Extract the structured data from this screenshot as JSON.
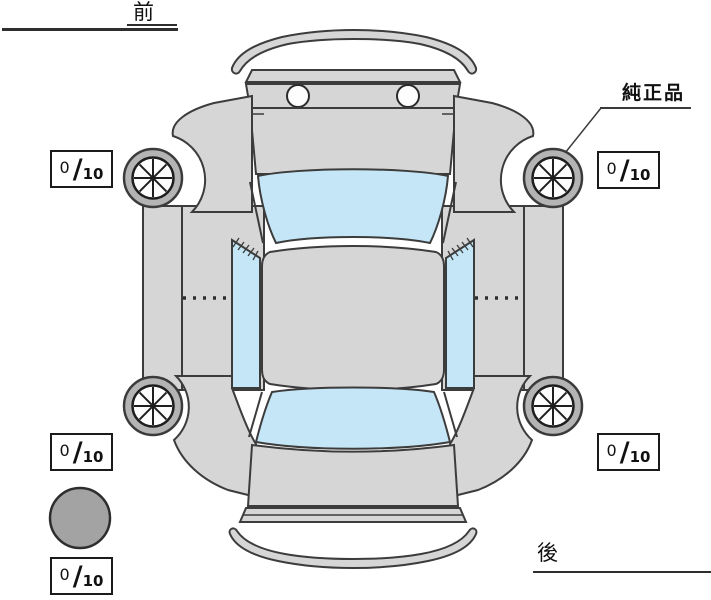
{
  "labels": {
    "front": "前",
    "rear": "後",
    "genuine_parts": "純正品"
  },
  "slash_char": "/",
  "tires": {
    "front_left": {
      "value": "0",
      "max": "10"
    },
    "front_right": {
      "value": "0",
      "max": "10"
    },
    "rear_left": {
      "value": "0",
      "max": "10"
    },
    "rear_right": {
      "value": "0",
      "max": "10"
    },
    "spare": {
      "value": "0",
      "max": "10"
    }
  },
  "colors": {
    "body_gray": "#d6d6d6",
    "glass_blue": "#c5e6f7",
    "tire_gray": "#b4b4b4",
    "spare_gray": "#a3a3a3",
    "outline": "#3c3c3c",
    "background": "#ffffff"
  }
}
